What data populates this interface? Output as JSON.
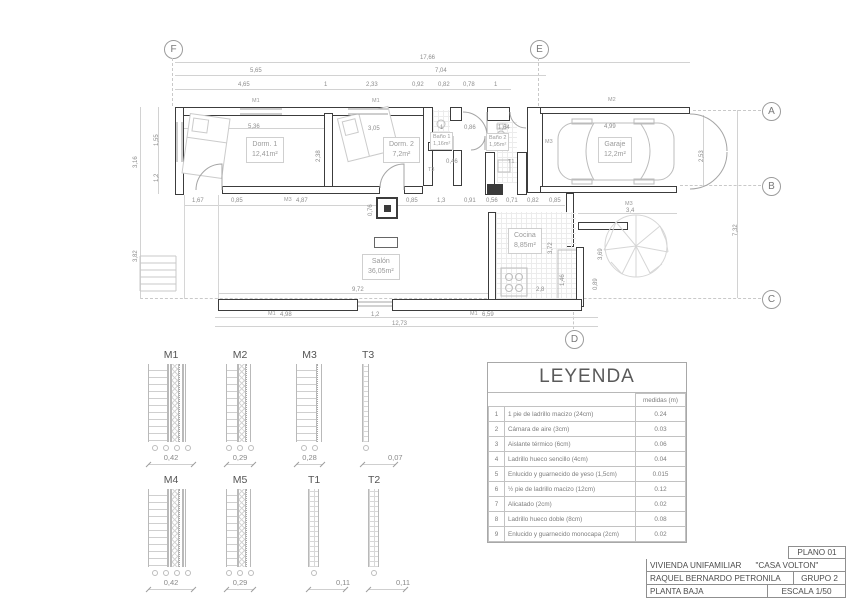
{
  "plan": {
    "grid": {
      "f": "F",
      "e": "E",
      "a": "A",
      "b": "B",
      "c": "C",
      "d": "D"
    },
    "rooms": {
      "dorm1": {
        "name": "Dorm. 1",
        "area": "12,41m²"
      },
      "dorm2": {
        "name": "Dorm. 2",
        "area": "7,2m²"
      },
      "bano1": {
        "name": "Baño 1",
        "area": "1,16m²"
      },
      "bano2": {
        "name": "Baño 2",
        "area": "1,95m²"
      },
      "garaje": {
        "name": "Garaje",
        "area": "12,2m²"
      },
      "cocina": {
        "name": "Cocina",
        "area": "8,85m²"
      },
      "salon": {
        "name": "Salón",
        "area": "36,05m²"
      }
    },
    "dims": {
      "total": "17,66",
      "segL": "5,65",
      "segR": "7,04",
      "r3a": "4,65",
      "r3b": "1",
      "r3c": "2,33",
      "r3d": "0,92",
      "r3e": "0,82",
      "r3f": "0,78",
      "r3g": "1",
      "lo": "3,16",
      "la": "1,55",
      "lb": "1,2",
      "lc": "3,82",
      "m1": "1,67",
      "m2": "0,85",
      "m3": "4,87",
      "m4": "0,85",
      "m5": "1,3",
      "m6": "0,91",
      "m7": "0,56",
      "m8": "0,71",
      "m9": "0,82",
      "m10": "0,85",
      "d1w": "5,36",
      "d1h": "2,38",
      "d2w": "3,05",
      "b1w": "1",
      "entry": "0,86",
      "b2w": "1,64",
      "stub": "0,46",
      "pillar": "0,76",
      "gw": "4,99",
      "gh": "2,53",
      "rtot": "7,32",
      "treew": "3,4",
      "treeh": "3,69",
      "k1": "3,72",
      "k2": "1,46",
      "k3": "0,89",
      "stove": "2,8",
      "salonw": "9,72",
      "bb1": "4,98",
      "bb2": "1,2",
      "bb3": "6,59",
      "btot": "12,73"
    },
    "tags": {
      "m1a": "M1",
      "m1b": "M1",
      "m2": "M2",
      "m3a": "M3",
      "m3b": "M3",
      "m3c": "M3",
      "t3": "T3",
      "t1": "T1",
      "m1c": "M1",
      "m1d": "M1"
    }
  },
  "details": {
    "items": [
      {
        "label": "M1",
        "dim": "0,42"
      },
      {
        "label": "M2",
        "dim": "0,29"
      },
      {
        "label": "M3",
        "dim": "0,28"
      },
      {
        "label": "T3",
        "dim": "0,07"
      },
      {
        "label": "M4",
        "dim": "0,42"
      },
      {
        "label": "M5",
        "dim": "0,29"
      },
      {
        "label": "T1",
        "dim": "0,11"
      },
      {
        "label": "T2",
        "dim": "0,11"
      }
    ]
  },
  "legend": {
    "title": "LEYENDA",
    "col_header": "medidas (m)",
    "rows": [
      {
        "num": "1",
        "desc": "1 pie de ladrillo macizo (24cm)",
        "val": "0.24"
      },
      {
        "num": "2",
        "desc": "Cámara de aire (3cm)",
        "val": "0.03"
      },
      {
        "num": "3",
        "desc": "Aislante térmico (6cm)",
        "val": "0.06"
      },
      {
        "num": "4",
        "desc": "Ladrillo hueco sencillo (4cm)",
        "val": "0.04"
      },
      {
        "num": "5",
        "desc": "Enlucido y guarnecido de yeso (1,5cm)",
        "val": "0.015"
      },
      {
        "num": "6",
        "desc": "½ pie de ladrillo macizo (12cm)",
        "val": "0.12"
      },
      {
        "num": "7",
        "desc": "Alicatado (2cm)",
        "val": "0.02"
      },
      {
        "num": "8",
        "desc": "Ladrillo hueco doble (8cm)",
        "val": "0.08"
      },
      {
        "num": "9",
        "desc": "Enlucido y guarnecido monocapa (2cm)",
        "val": "0.02"
      }
    ]
  },
  "titleblock": {
    "plano": "PLANO 01",
    "project": "VIVIENDA UNIFAMILIAR",
    "name": "\"CASA VOLTON\"",
    "author": "RAQUEL BERNARDO PETRONILA",
    "group": "GRUPO 2",
    "floor": "PLANTA BAJA",
    "scale": "ESCALA 1/50"
  }
}
